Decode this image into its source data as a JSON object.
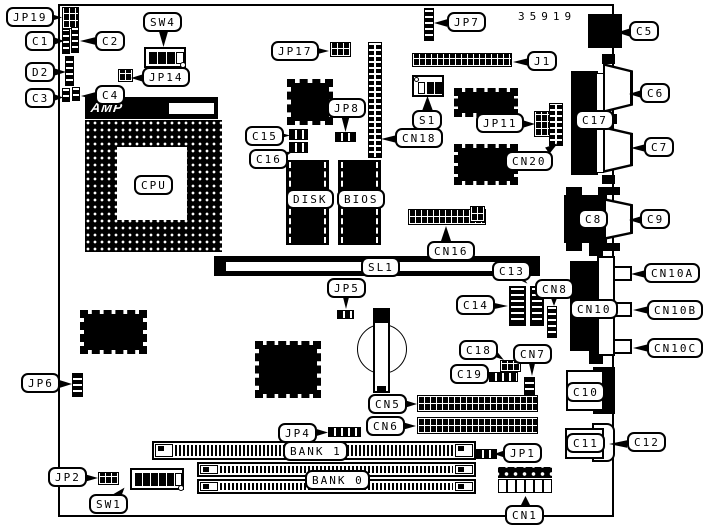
{
  "diagram": {
    "type": "motherboard-component-location",
    "board_number": "35919",
    "logo_text": "AMP",
    "callouts": {
      "jp19": "JP19",
      "c1": "C1",
      "c2": "C2",
      "d2": "D2",
      "c3": "C3",
      "c4": "C4",
      "sw4": "SW4",
      "jp14": "JP14",
      "jp17": "JP17",
      "jp7": "JP7",
      "c5": "C5",
      "j1": "J1",
      "s1": "S1",
      "cn18": "CN18",
      "jp8": "JP8",
      "c15": "C15",
      "c16": "C16",
      "jp11": "JP11",
      "cn20": "CN20",
      "c17": "C17",
      "c6": "C6",
      "c7": "C7",
      "cpu": "CPU",
      "disk": "DISK",
      "bios": "BIOS",
      "cn16": "CN16",
      "sl1": "SL1",
      "c13": "C13",
      "c8": "C8",
      "c9": "C9",
      "jp5": "JP5",
      "c14": "C14",
      "cn8": "CN8",
      "cn10": "CN10",
      "cn10a": "CN10A",
      "cn10b": "CN10B",
      "cn10c": "CN10C",
      "c18": "C18",
      "c19": "C19",
      "cn7": "CN7",
      "jp6": "JP6",
      "c10": "C10",
      "cn5": "CN5",
      "cn6": "CN6",
      "jp4": "JP4",
      "bank1": "BANK 1",
      "bank0": "BANK 0",
      "jp1": "JP1",
      "c11": "C11",
      "c12": "C12",
      "jp2": "JP2",
      "sw1": "SW1",
      "cn1": "CN1"
    }
  }
}
